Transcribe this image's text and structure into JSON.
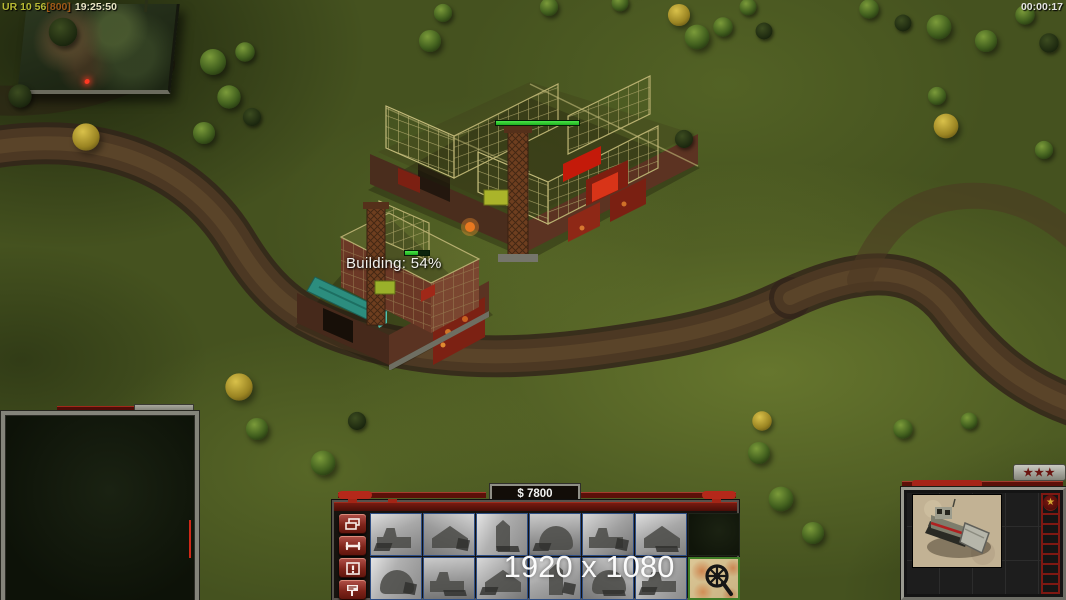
{
  "hud": {
    "debug_text": {
      "prefix": "UR 10 56",
      "bracket": "[800]",
      "clock": "19:25:50"
    },
    "match_timer": "00:00:17",
    "resolution_overlay": "1920 x 1080"
  },
  "world": {
    "building_progress_label": "Building: 54%",
    "structures": [
      "command-center",
      "large-construction-site",
      "small-construction-site"
    ]
  },
  "command_bar": {
    "money": "$ 7800",
    "side_buttons": [
      {
        "name": "formation-button",
        "icon": "layers-icon"
      },
      {
        "name": "repair-button",
        "icon": "wrench-icon"
      },
      {
        "name": "alert-button",
        "icon": "exclamation-icon"
      },
      {
        "name": "sell-button",
        "icon": "sell-sign-icon"
      }
    ],
    "build_grid": {
      "row1": [
        "thumb",
        "thumb",
        "thumb",
        "thumb",
        "thumb",
        "thumb",
        "empty"
      ],
      "row2": [
        "thumb",
        "thumb",
        "thumb",
        "thumb",
        "thumb",
        "thumb",
        "special-map"
      ]
    }
  },
  "right_panel": {
    "rank_stars": "★★★",
    "emblem_star": "★",
    "unit": "construction-dozer"
  }
}
